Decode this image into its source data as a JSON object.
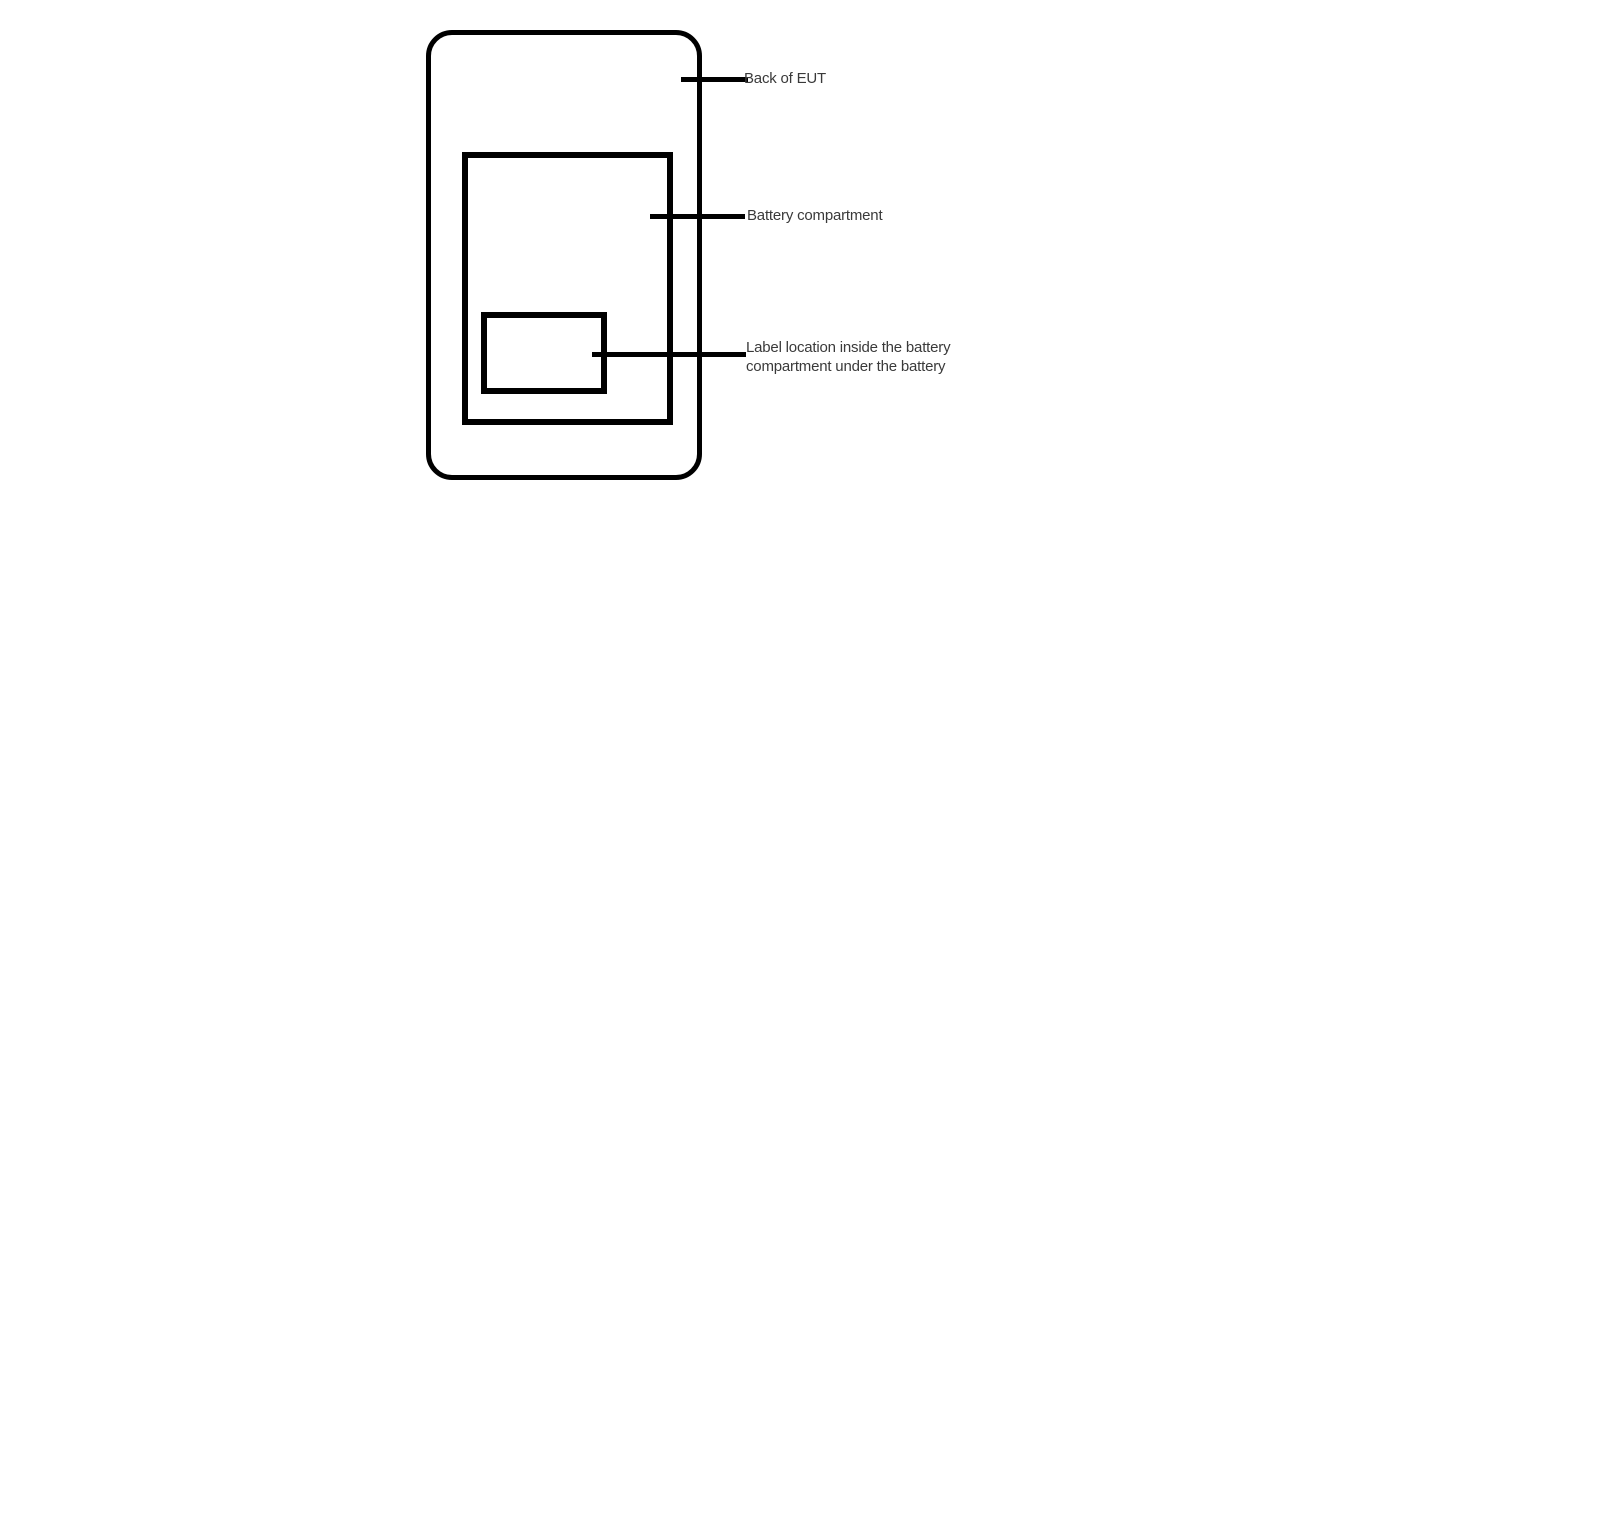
{
  "diagram": {
    "labels": {
      "back_of_eut": "Back of EUT",
      "battery_compartment": "Battery compartment",
      "label_location_line1": "Label location inside the battery",
      "label_location_line2": "compartment under the battery"
    },
    "colors": {
      "line": "#000000",
      "text": "#3a3a3a",
      "background": "#ffffff"
    }
  }
}
